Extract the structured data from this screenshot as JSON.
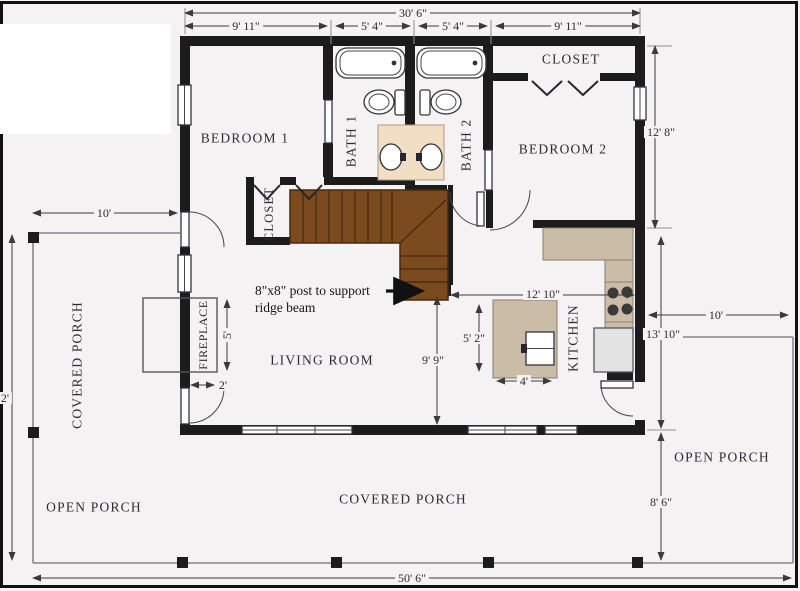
{
  "rooms": {
    "bedroom1": "BEDROOM 1",
    "bath1": "BATH 1",
    "bath2": "BATH 2",
    "closet_top": "CLOSET",
    "bedroom2": "BEDROOM 2",
    "closet_stairs": "CLOSET",
    "living_room": "LIVING ROOM",
    "kitchen": "KITCHEN",
    "fireplace": "FIREPLACE",
    "covered_porch_left": "COVERED PORCH",
    "covered_porch_bottom": "COVERED PORCH",
    "open_porch_bottom_left": "OPEN PORCH",
    "open_porch_right": "OPEN PORCH"
  },
  "dims": {
    "overall_width": "30' 6\"",
    "seg_left": "9' 11\"",
    "seg_bath1": "5' 4\"",
    "seg_bath2": "5' 4\"",
    "seg_right": "9' 11\"",
    "bedroom2_depth": "12' 8\"",
    "porch_left_depth": "10'",
    "porch_right_width": "10'",
    "kitchen_zone_height": "13' 10\"",
    "porch_bottom_depth": "8' 6\"",
    "overall_length": "50' 6\"",
    "living_height": "9' 9\"",
    "kitchen_width": "12' 10\"",
    "island_height": "5' 2\"",
    "island_width": "4'",
    "fireplace_height": "5'",
    "fireplace_depth": "2'",
    "left_edge_partial": "2'"
  },
  "annotation": {
    "post_note_line1": "8\"x8\" post to support",
    "post_note_line2": "ridge beam"
  },
  "colors": {
    "background": "#f5f2f3",
    "wall": "#1c1c1c",
    "stairs": "#7b4a1f",
    "stairs_line": "#46290e",
    "counter": "#cbbca8",
    "vanity": "#f2ddc5",
    "fridge": "#e3e3e3",
    "dimension": "#3a3a3a"
  }
}
